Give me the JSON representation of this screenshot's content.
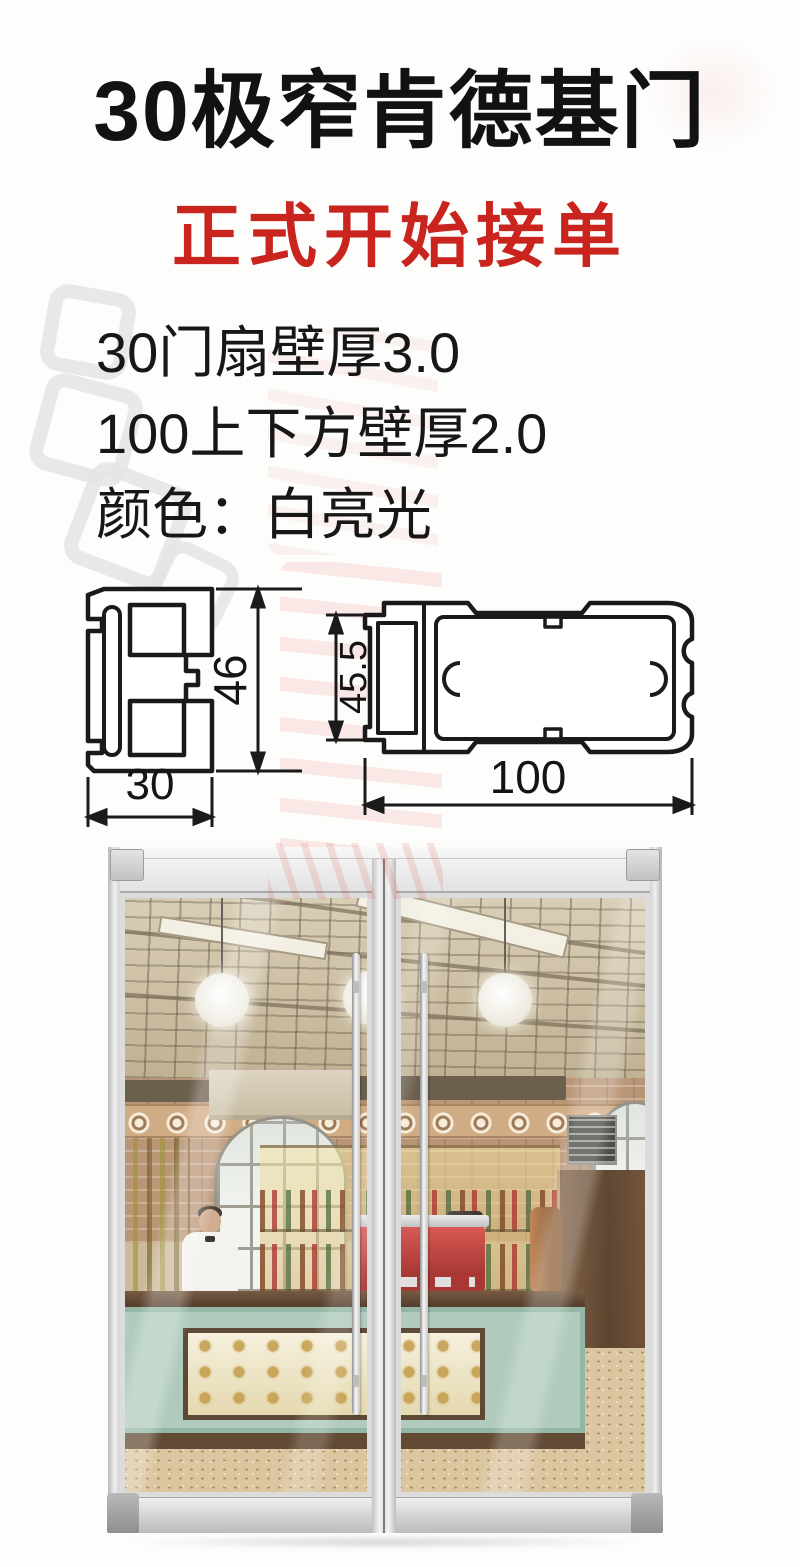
{
  "flyer": {
    "title": "30极窄肯德基门",
    "subtitle": "正式开始接单",
    "spec_lines": [
      "30门扇壁厚3.0",
      "100上下方壁厚2.0",
      "颜色：白亮光"
    ],
    "colors": {
      "title_ink": "#121212",
      "accent_red": "#c9241e",
      "diagram_line": "#1a1a1a"
    }
  },
  "diagrams": {
    "sash": {
      "height_dim": "46",
      "width_dim": "30"
    },
    "tube": {
      "height_dim": "45.5",
      "width_dim": "100"
    }
  }
}
